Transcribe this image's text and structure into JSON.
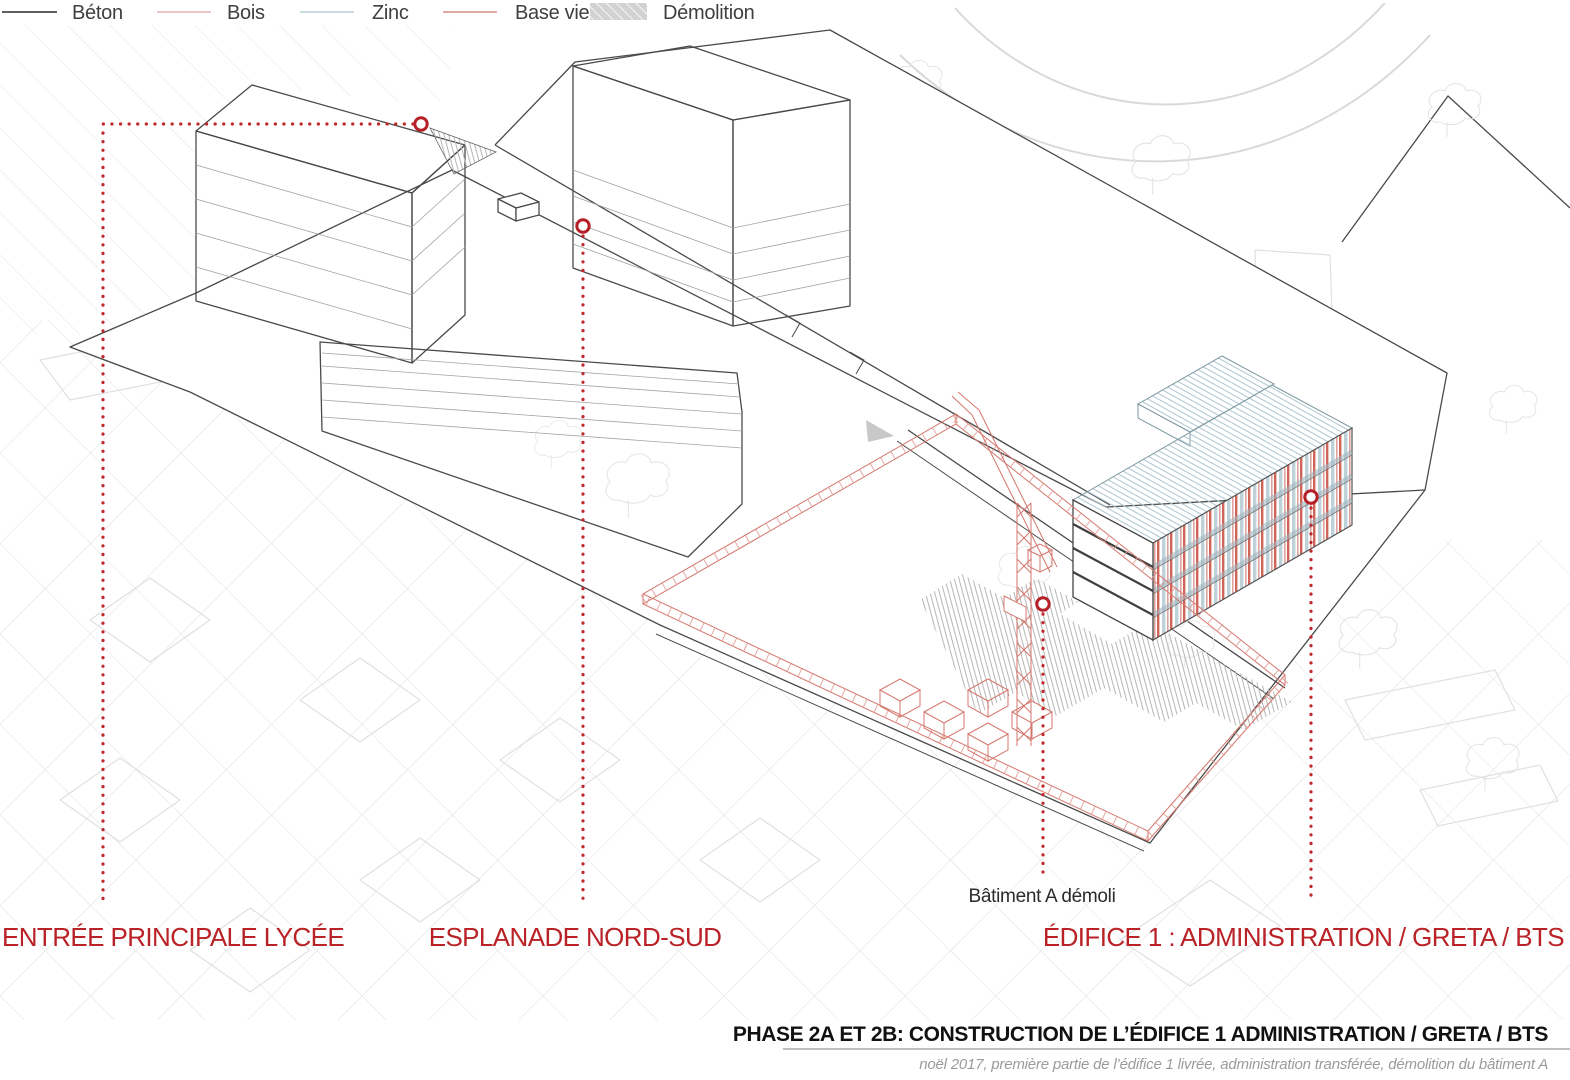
{
  "legend": {
    "items": [
      {
        "id": "beton",
        "label": "Béton",
        "swatch": "line",
        "color": "#2a2a2a"
      },
      {
        "id": "bois",
        "label": "Bois",
        "swatch": "line",
        "color": "#e3b3b8"
      },
      {
        "id": "zinc",
        "label": "Zinc",
        "swatch": "line",
        "color": "#b9cdd6"
      },
      {
        "id": "base-vie",
        "label": "Base vie",
        "swatch": "line",
        "color": "#d98e85"
      },
      {
        "id": "demolition",
        "label": "Démolition",
        "swatch": "hatch",
        "color": "#d2d2d2"
      }
    ]
  },
  "callouts": {
    "entree": {
      "label": "ENTRÉE PRINCIPALE LYCÉE",
      "color": "#b92227"
    },
    "esplanade": {
      "label": "ESPLANADE NORD-SUD",
      "color": "#b92227"
    },
    "batiment_a": {
      "label": "Bâtiment A démoli",
      "color": "#2b2b2b"
    },
    "edifice1": {
      "label": "ÉDIFICE 1 : ADMINISTRATION / GRETA / BTS",
      "color": "#b92227"
    }
  },
  "caption": {
    "title": "PHASE 2A ET 2B: CONSTRUCTION DE L’ÉDIFICE 1 ADMINISTRATION / GRETA / BTS",
    "subtitle": "noël 2017, première partie de l’édifice 1 livrée, administration transférée, démolition du bâtiment A"
  }
}
